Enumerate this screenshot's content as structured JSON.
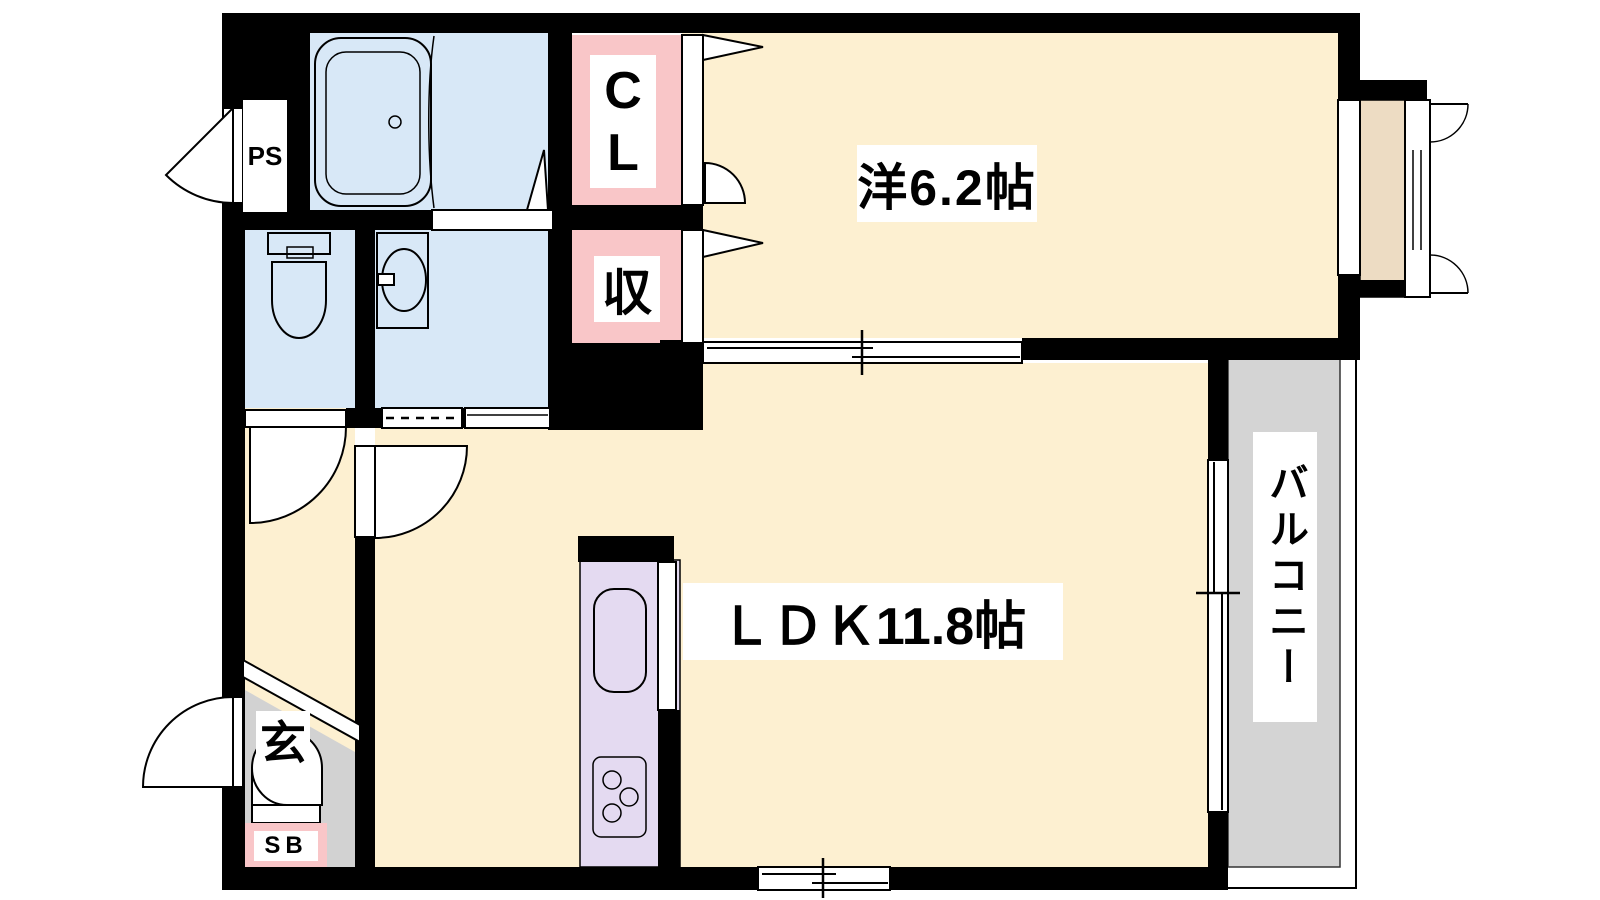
{
  "title": "1LDK apartment floor plan",
  "colors": {
    "wall": "#000000",
    "room_floor": "#fdf0d1",
    "wet_area": "#d8e8f7",
    "closet_bg": "#f9c6c8",
    "kitchen": "#e4daf1",
    "balcony": "#d4d4d4",
    "genkan": "#d2d2d2",
    "sill": "#eddcc3",
    "label_bg": "#ffffff"
  },
  "rooms": {
    "western_room": {
      "label": "洋6.2帖",
      "type": "bedroom"
    },
    "ldk": {
      "label": "ＬＤＫ11.8帖",
      "type": "living-dining-kitchen"
    },
    "balcony": {
      "label": "バルコニー",
      "type": "balcony"
    },
    "closet": {
      "label": "CL",
      "type": "closet"
    },
    "storage": {
      "label": "収",
      "type": "storage"
    },
    "entrance": {
      "label": "玄",
      "type": "entrance-hall"
    },
    "shoe_box": {
      "label": "SB",
      "type": "shoe-box"
    },
    "pipe_space": {
      "label": "PS",
      "type": "pipe-space"
    }
  },
  "fixtures": [
    "bathtub",
    "toilet",
    "washbasin",
    "washing-machine-space",
    "kitchen-sink",
    "gas-stove",
    "sliding-doors",
    "hinged-doors",
    "windows"
  ]
}
